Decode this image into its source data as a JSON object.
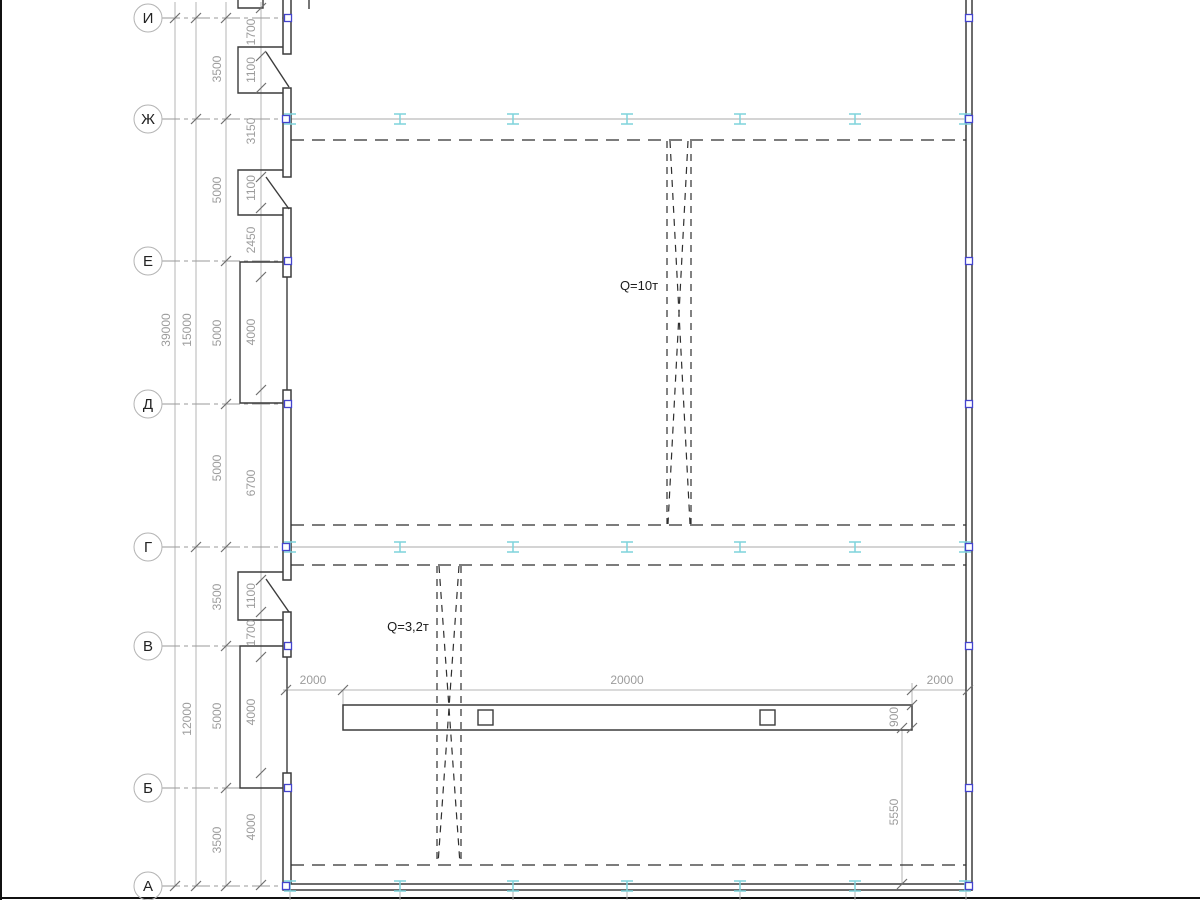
{
  "axes": {
    "rows": [
      {
        "label": "И"
      },
      {
        "label": "Ж"
      },
      {
        "label": "Е"
      },
      {
        "label": "Д"
      },
      {
        "label": "Г"
      },
      {
        "label": "В"
      },
      {
        "label": "Б"
      },
      {
        "label": "А"
      }
    ]
  },
  "dims": {
    "overall": [
      {
        "label": "39000"
      },
      {
        "label": "15000"
      },
      {
        "label": "12000"
      }
    ],
    "bays": [
      {
        "label": "3500"
      },
      {
        "label": "5000"
      },
      {
        "label": "5000"
      },
      {
        "label": "5000"
      },
      {
        "label": "3500"
      },
      {
        "label": "5000"
      },
      {
        "label": "3500"
      }
    ],
    "detail": [
      {
        "label": "1700"
      },
      {
        "label": "1100"
      },
      {
        "label": "3150"
      },
      {
        "label": "1100"
      },
      {
        "label": "2450"
      },
      {
        "label": "4000"
      },
      {
        "label": "6700"
      },
      {
        "label": "1100"
      },
      {
        "label": "1700"
      },
      {
        "label": "4000"
      },
      {
        "label": "4000"
      }
    ],
    "bottom": [
      {
        "label": "2000"
      },
      {
        "label": "20000"
      },
      {
        "label": "2000"
      }
    ],
    "beam": [
      {
        "label": "900"
      },
      {
        "label": "5550"
      }
    ]
  },
  "annotations": {
    "cranes": [
      {
        "label": "Q=10т"
      },
      {
        "label": "Q=3,2т"
      }
    ]
  },
  "colors": {
    "wall": "#3c3c3c",
    "dimension": "#9c9c9c",
    "rail_marker": "#7fd3dc",
    "node_marker": "#4444cc"
  }
}
